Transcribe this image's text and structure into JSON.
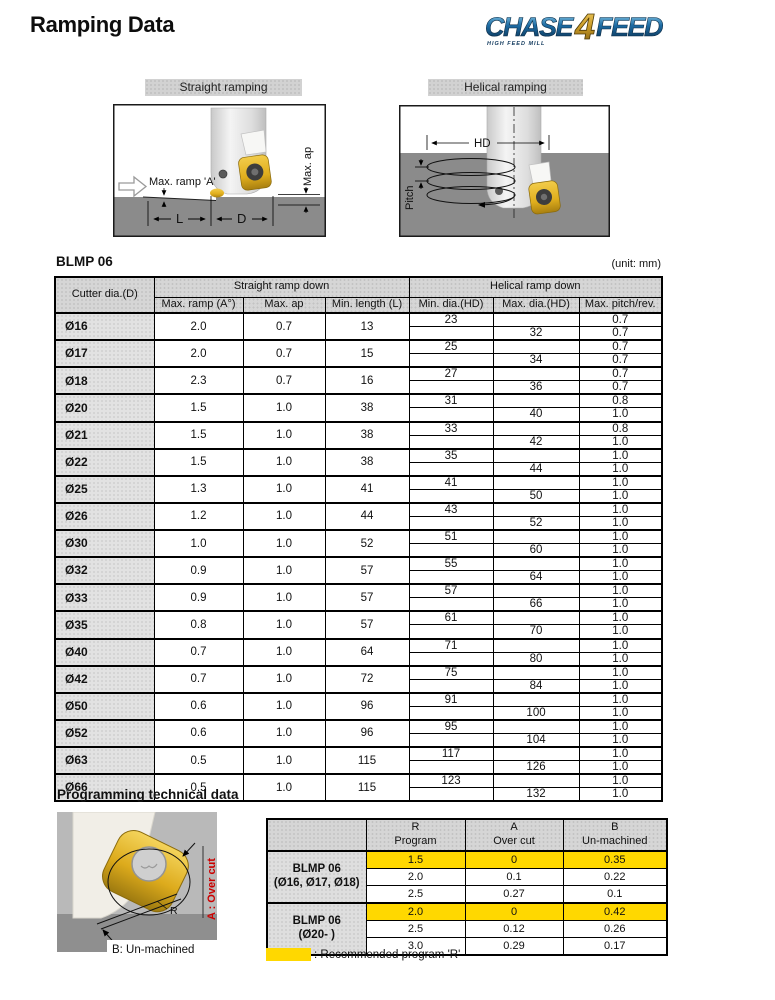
{
  "page": {
    "title": "Ramping Data"
  },
  "logo": {
    "chase": "CHASE",
    "four": "4",
    "feed": "FEED",
    "subtext": "HIGH FEED MILL"
  },
  "figures": {
    "straight": {
      "label": "Straight ramping",
      "annotations": {
        "max_ramp": "Max. ramp 'A'",
        "max_ap": "Max. ap",
        "l": "L",
        "d": "D"
      }
    },
    "helical": {
      "label": "Helical ramping",
      "annotations": {
        "hd": "HD",
        "pitch": "Pitch"
      }
    }
  },
  "ramping_table": {
    "title": "BLMP 06",
    "unit_note": "(unit: mm)",
    "group_headers": {
      "straight": "Straight ramp down",
      "helical": "Helical ramp down"
    },
    "columns": {
      "cutter": "Cutter dia.(D)",
      "max_ramp": "Max. ramp (A°)",
      "max_ap": "Max. ap",
      "min_length": "Min. length (L)",
      "min_dia": "Min. dia.(HD)",
      "max_dia": "Max. dia.(HD)",
      "max_pitch": "Max. pitch/rev."
    },
    "rows": [
      {
        "dia": "Ø16",
        "max_ramp": "2.0",
        "max_ap": "0.7",
        "min_length": "13",
        "min_dia": "23",
        "max_dia": "32",
        "pitch_top": "0.7",
        "pitch_bottom": "0.7"
      },
      {
        "dia": "Ø17",
        "max_ramp": "2.0",
        "max_ap": "0.7",
        "min_length": "15",
        "min_dia": "25",
        "max_dia": "34",
        "pitch_top": "0.7",
        "pitch_bottom": "0.7"
      },
      {
        "dia": "Ø18",
        "max_ramp": "2.3",
        "max_ap": "0.7",
        "min_length": "16",
        "min_dia": "27",
        "max_dia": "36",
        "pitch_top": "0.7",
        "pitch_bottom": "0.7"
      },
      {
        "dia": "Ø20",
        "max_ramp": "1.5",
        "max_ap": "1.0",
        "min_length": "38",
        "min_dia": "31",
        "max_dia": "40",
        "pitch_top": "0.8",
        "pitch_bottom": "1.0"
      },
      {
        "dia": "Ø21",
        "max_ramp": "1.5",
        "max_ap": "1.0",
        "min_length": "38",
        "min_dia": "33",
        "max_dia": "42",
        "pitch_top": "0.8",
        "pitch_bottom": "1.0"
      },
      {
        "dia": "Ø22",
        "max_ramp": "1.5",
        "max_ap": "1.0",
        "min_length": "38",
        "min_dia": "35",
        "max_dia": "44",
        "pitch_top": "1.0",
        "pitch_bottom": "1.0"
      },
      {
        "dia": "Ø25",
        "max_ramp": "1.3",
        "max_ap": "1.0",
        "min_length": "41",
        "min_dia": "41",
        "max_dia": "50",
        "pitch_top": "1.0",
        "pitch_bottom": "1.0"
      },
      {
        "dia": "Ø26",
        "max_ramp": "1.2",
        "max_ap": "1.0",
        "min_length": "44",
        "min_dia": "43",
        "max_dia": "52",
        "pitch_top": "1.0",
        "pitch_bottom": "1.0"
      },
      {
        "dia": "Ø30",
        "max_ramp": "1.0",
        "max_ap": "1.0",
        "min_length": "52",
        "min_dia": "51",
        "max_dia": "60",
        "pitch_top": "1.0",
        "pitch_bottom": "1.0"
      },
      {
        "dia": "Ø32",
        "max_ramp": "0.9",
        "max_ap": "1.0",
        "min_length": "57",
        "min_dia": "55",
        "max_dia": "64",
        "pitch_top": "1.0",
        "pitch_bottom": "1.0"
      },
      {
        "dia": "Ø33",
        "max_ramp": "0.9",
        "max_ap": "1.0",
        "min_length": "57",
        "min_dia": "57",
        "max_dia": "66",
        "pitch_top": "1.0",
        "pitch_bottom": "1.0"
      },
      {
        "dia": "Ø35",
        "max_ramp": "0.8",
        "max_ap": "1.0",
        "min_length": "57",
        "min_dia": "61",
        "max_dia": "70",
        "pitch_top": "1.0",
        "pitch_bottom": "1.0"
      },
      {
        "dia": "Ø40",
        "max_ramp": "0.7",
        "max_ap": "1.0",
        "min_length": "64",
        "min_dia": "71",
        "max_dia": "80",
        "pitch_top": "1.0",
        "pitch_bottom": "1.0"
      },
      {
        "dia": "Ø42",
        "max_ramp": "0.7",
        "max_ap": "1.0",
        "min_length": "72",
        "min_dia": "75",
        "max_dia": "84",
        "pitch_top": "1.0",
        "pitch_bottom": "1.0"
      },
      {
        "dia": "Ø50",
        "max_ramp": "0.6",
        "max_ap": "1.0",
        "min_length": "96",
        "min_dia": "91",
        "max_dia": "100",
        "pitch_top": "1.0",
        "pitch_bottom": "1.0"
      },
      {
        "dia": "Ø52",
        "max_ramp": "0.6",
        "max_ap": "1.0",
        "min_length": "96",
        "min_dia": "95",
        "max_dia": "104",
        "pitch_top": "1.0",
        "pitch_bottom": "1.0"
      },
      {
        "dia": "Ø63",
        "max_ramp": "0.5",
        "max_ap": "1.0",
        "min_length": "115",
        "min_dia": "117",
        "max_dia": "126",
        "pitch_top": "1.0",
        "pitch_bottom": "1.0"
      },
      {
        "dia": "Ø66",
        "max_ramp": "0.5",
        "max_ap": "1.0",
        "min_length": "115",
        "min_dia": "123",
        "max_dia": "132",
        "pitch_top": "1.0",
        "pitch_bottom": "1.0"
      }
    ]
  },
  "programming": {
    "heading": "Programming technical data",
    "photo_labels": {
      "r": "R",
      "over_cut": "A : Over cut",
      "un_machined": "B: Un-machined"
    },
    "columns": [
      {
        "line1": "R",
        "line2": "Program"
      },
      {
        "line1": "A",
        "line2": "Over cut"
      },
      {
        "line1": "B",
        "line2": "Un-machined"
      }
    ],
    "groups": [
      {
        "label_line1": "BLMP 06",
        "label_line2": "(Ø16, Ø17, Ø18)",
        "rows": [
          {
            "r": "1.5",
            "a": "0",
            "b": "0.35",
            "highlight": true
          },
          {
            "r": "2.0",
            "a": "0.1",
            "b": "0.22",
            "highlight": false
          },
          {
            "r": "2.5",
            "a": "0.27",
            "b": "0.1",
            "highlight": false
          }
        ]
      },
      {
        "label_line1": "BLMP 06",
        "label_line2": "(Ø20- )",
        "rows": [
          {
            "r": "2.0",
            "a": "0",
            "b": "0.42",
            "highlight": true
          },
          {
            "r": "2.5",
            "a": "0.12",
            "b": "0.26",
            "highlight": false
          },
          {
            "r": "3.0",
            "a": "0.29",
            "b": "0.17",
            "highlight": false
          }
        ]
      }
    ],
    "legend": ": Recommended program 'R'"
  },
  "colors": {
    "highlight_yellow": "#ffd800",
    "header_gray": "#d6d6d6",
    "ground_gray": "#8b8b8b",
    "insert_gold": "#e0ae1d",
    "logo_blue": "#14507f",
    "logo_gold": "#c99a27",
    "annotation_red": "#cc0000"
  }
}
